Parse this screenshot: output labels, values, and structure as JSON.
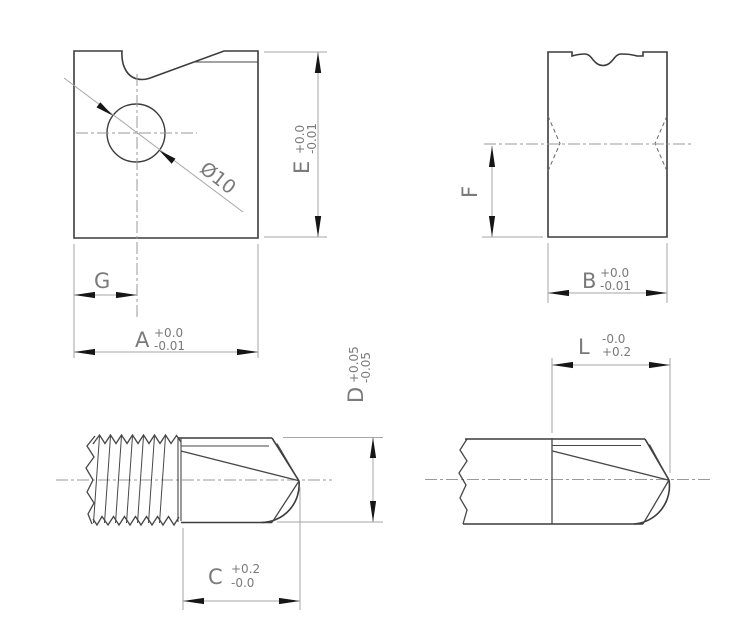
{
  "drawing_labels": {
    "hole_diameter": "Ø10",
    "dims": {
      "E": {
        "letter": "E",
        "upper": "+0.0",
        "lower": "-0.01"
      },
      "G": {
        "letter": "G"
      },
      "A": {
        "letter": "A",
        "upper": "+0.0",
        "lower": "-0.01"
      },
      "F": {
        "letter": "F"
      },
      "B": {
        "letter": "B",
        "upper": "+0.0",
        "lower": "-0.01"
      },
      "D": {
        "letter": "D",
        "upper": "+0.05",
        "lower": "-0.05"
      },
      "C": {
        "letter": "C",
        "upper": "+0.2",
        "lower": "-0.0"
      },
      "L": {
        "letter": "L",
        "upper": "-0.0",
        "lower": "+0.2"
      }
    }
  },
  "colors": {
    "outline": "#3c3c3c",
    "dimension_lines": "#a6a6a6",
    "centerlines": "#9a9a9a",
    "arrowheads": "#161616",
    "text": "#7a7a7a",
    "background": "#ffffff"
  }
}
